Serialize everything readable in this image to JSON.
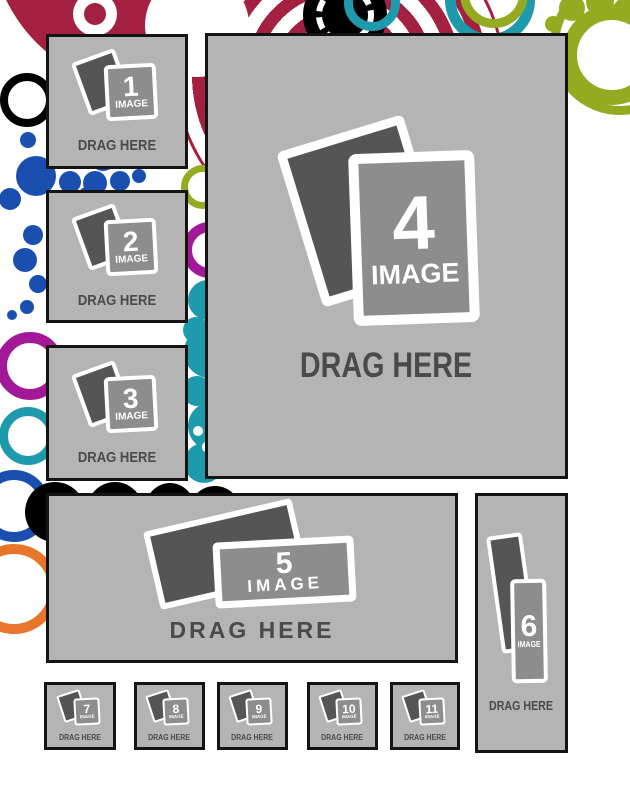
{
  "page": {
    "type": "photo-collage-drag-drop-template",
    "background": "#ffffff"
  },
  "colors": {
    "slot_background": "#b4b4b4",
    "slot_border": "#141414",
    "photo_back": "#555555",
    "photo_front": "#8d8d8d",
    "photo_outline": "#ffffff",
    "drag_text": "#4a4a4a",
    "decor_crimson": "#A32040",
    "decor_blue": "#1B4FAF",
    "decor_teal": "#1E9AAD",
    "decor_olive": "#94AB21",
    "decor_magenta": "#A31899",
    "decor_orange": "#E8762A",
    "decor_black": "#000000"
  },
  "slots": [
    {
      "number": "1",
      "image_label": "IMAGE",
      "drag_label": "DRAG HERE"
    },
    {
      "number": "2",
      "image_label": "IMAGE",
      "drag_label": "DRAG HERE"
    },
    {
      "number": "3",
      "image_label": "IMAGE",
      "drag_label": "DRAG HERE"
    },
    {
      "number": "4",
      "image_label": "IMAGE",
      "drag_label": "DRAG HERE"
    },
    {
      "number": "5",
      "image_label": "IMAGE",
      "drag_label": "DRAG HERE"
    },
    {
      "number": "6",
      "image_label": "IMAGE",
      "drag_label": "DRAG HERE"
    },
    {
      "number": "7",
      "image_label": "IMAGE",
      "drag_label": "DRAG HERE"
    },
    {
      "number": "8",
      "image_label": "IMAGE",
      "drag_label": "DRAG HERE"
    },
    {
      "number": "9",
      "image_label": "IMAGE",
      "drag_label": "DRAG HERE"
    },
    {
      "number": "10",
      "image_label": "IMAGE",
      "drag_label": "DRAG HERE"
    },
    {
      "number": "11",
      "image_label": "IMAGE",
      "drag_label": "DRAG HERE"
    }
  ]
}
